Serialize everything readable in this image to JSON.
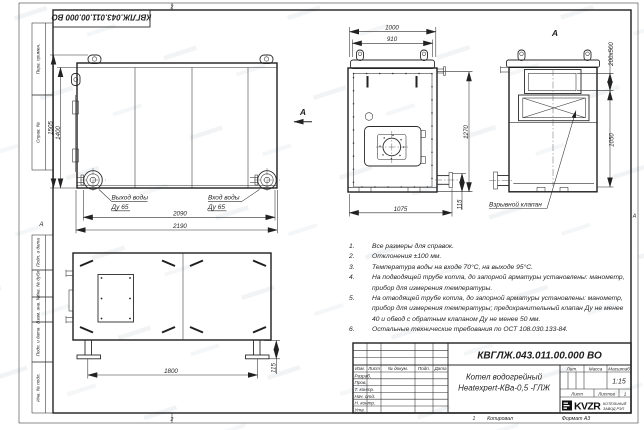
{
  "sheet": {
    "stamp_doc_number": "КВГЛЖ.043.011.00.000 ВО",
    "margin_labels": [
      "Перв. примен.",
      "Справ. №",
      "Подп. и дата",
      "Инв. № дубл.",
      "Взам. инв. №",
      "Подп. и дата",
      "Инв. № подл."
    ],
    "zone_letter_left": "А",
    "zone_letter_right": "А",
    "fold_mark_top": "2",
    "fold_mark_bottom": "2",
    "fold_mark_bottom_right": "1",
    "copied_label": "Копировал",
    "format_label": "Формат А3"
  },
  "views": {
    "side": {
      "dim_height_overall": "1505",
      "dim_height_body": "1400",
      "dim_width_inner": "2090",
      "dim_width_overall": "2190",
      "outlet_label": "Выход воды",
      "outlet_dn": "Ду 65",
      "inlet_label": "Вход воды",
      "inlet_dn": "Ду 65",
      "view_arrow_label": "А"
    },
    "front": {
      "dim_top_overall": "1000",
      "dim_top_inner": "910",
      "dim_height": "1270",
      "dim_bottom": "1075",
      "dim_stub": "115"
    },
    "view_a": {
      "label": "А",
      "dim_duct": "200х500",
      "dim_height": "1050",
      "valve_label": "Взрывной клапан"
    },
    "bottom": {
      "dim_feet_span": "1800",
      "dim_foot_height": "115"
    }
  },
  "notes": {
    "items": [
      {
        "num": "1.",
        "text": "Все размеры для справок."
      },
      {
        "num": "2.",
        "text": "Отклонения ±100 мм."
      },
      {
        "num": "3.",
        "text": "Температура воды на входе 70°С, на выходе 95°С."
      },
      {
        "num": "4.",
        "text": "На подводящей трубе котла, до запорной арматуры установлены: манометр, прибор для измерения температуры."
      },
      {
        "num": "5.",
        "text": "На отводящей трубе котла, до запорной арматуры установлены: манометр, прибор для измерения температуры; предохранительный клапан Ду не менее 40 и обвод с обратным клапаном Ду не менее 50 мм."
      },
      {
        "num": "6.",
        "text": "Остальные технические требования по ОСТ 108.030.133-84."
      }
    ]
  },
  "title_block": {
    "doc_number": "КВГЛЖ.043.011.00.000 ВО",
    "product_name_line1": "Котел водогрейный",
    "product_name_line2": "Heatexpert-КВа-0,5 -ГЛЖ",
    "header_cols": [
      "Изм.",
      "Лист",
      "№ докум.",
      "Подп.",
      "Дата"
    ],
    "sign_rows": [
      "Разраб.",
      "Пров.",
      "Т. контр.",
      "Нач. отд.",
      "Н. контр.",
      "Утв."
    ],
    "lit_label": "Лит.",
    "mass_label": "Масса",
    "scale_label": "Масштаб",
    "scale_value": "1:15",
    "sheet_label": "Лист",
    "sheets_label": "Листов",
    "sheets_value": "1",
    "logo_text": "KVZR",
    "logo_sub_line1": "КОТЕЛЬНЫЙ",
    "logo_sub_line2": "ЗАВОД РЭП"
  }
}
